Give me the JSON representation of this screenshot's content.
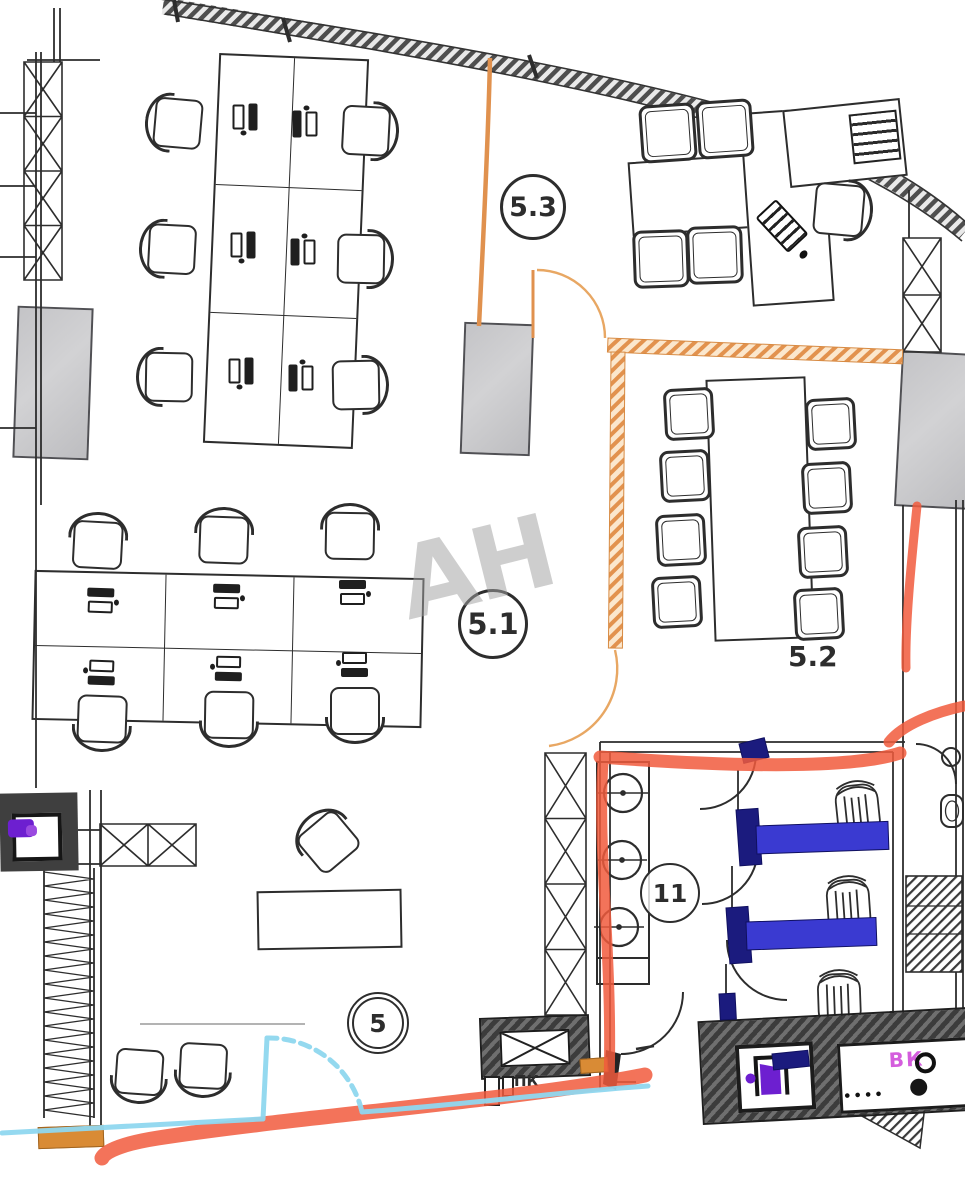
{
  "plan": {
    "title": "Office floor plan with markup",
    "watermark": "АН",
    "rooms": [
      {
        "id": "5.3",
        "label": "5.3",
        "kind": "open-office"
      },
      {
        "id": "5.1",
        "label": "5.1",
        "kind": "open-office"
      },
      {
        "id": "5.2",
        "label": "5.2",
        "kind": "meeting-room"
      },
      {
        "id": "11",
        "label": "11",
        "kind": "wc"
      },
      {
        "id": "5",
        "label": "5",
        "kind": "corridor"
      }
    ],
    "annotations": {
      "pk_label": "ПК",
      "vk_label": "ВК"
    },
    "colors": {
      "line": "#2d2d2d",
      "orange_wall": "#e0914e",
      "orange_fill": "#d98b35",
      "red_marker": "#f15b3d",
      "cyan_marker": "#8fd7ef",
      "blue_partition": "#3a3ad1",
      "navy_cap": "#1b1b7e",
      "purple_icon": "#6d1fd0",
      "magenta_label": "#d45ddd",
      "column_grey": "#c7c7c9",
      "watermark_grey": "#a2a2a2"
    },
    "icons": [
      "purple-door-icon",
      "purple-marker-icon",
      "sink-icon",
      "toilet-icon",
      "fire-cabinet-icon"
    ]
  }
}
